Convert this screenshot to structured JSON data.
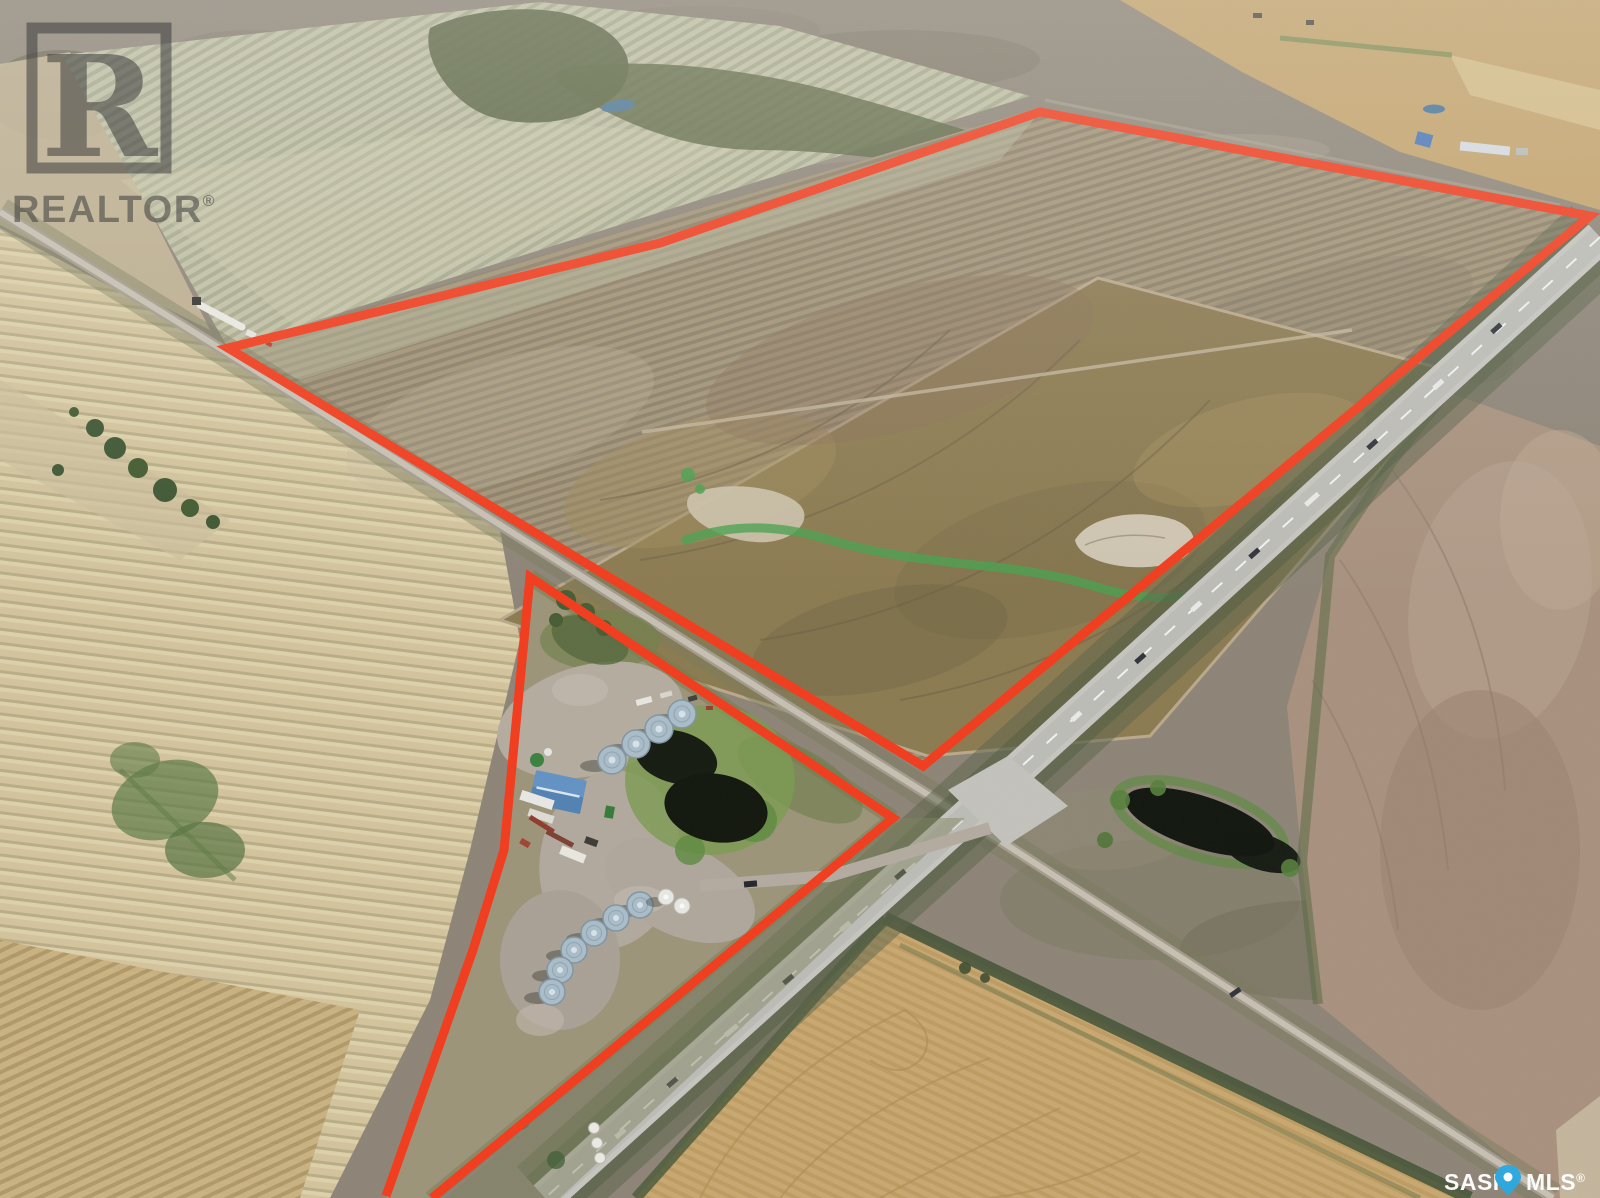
{
  "scene": {
    "type": "aerial-drone-photo",
    "subject": "Prairie farmland real-estate listing photo with two red-outlined parcels at a highway intersection, farmyard with grain bins, ponds and crop fields",
    "boundary_color": "#f23b1c"
  },
  "watermarks": {
    "realtor": {
      "letter": "R",
      "label": "REALTOR",
      "registered_mark": "®",
      "color": "#3d3d3d"
    },
    "sask_mls": {
      "label_left": "SASK",
      "label_right": "MLS",
      "registered_mark": "®",
      "text_color": "#ffffff",
      "pin_color": "#2ba9e1",
      "pin_dot_color": "#ffffff"
    }
  },
  "palette": {
    "pasture": "#8d8477",
    "pale_crop_field": "#c0c1a5",
    "tilled_field": "#a29377",
    "brown_field": "#8b7a50",
    "stubble_field": "#d3c49d",
    "wheat_field": "#c9a870",
    "pink_plowed_field": "#a8917e",
    "highway": "#c6c5c0",
    "pond": "#10150e",
    "vegetation": "#5e8a41"
  }
}
